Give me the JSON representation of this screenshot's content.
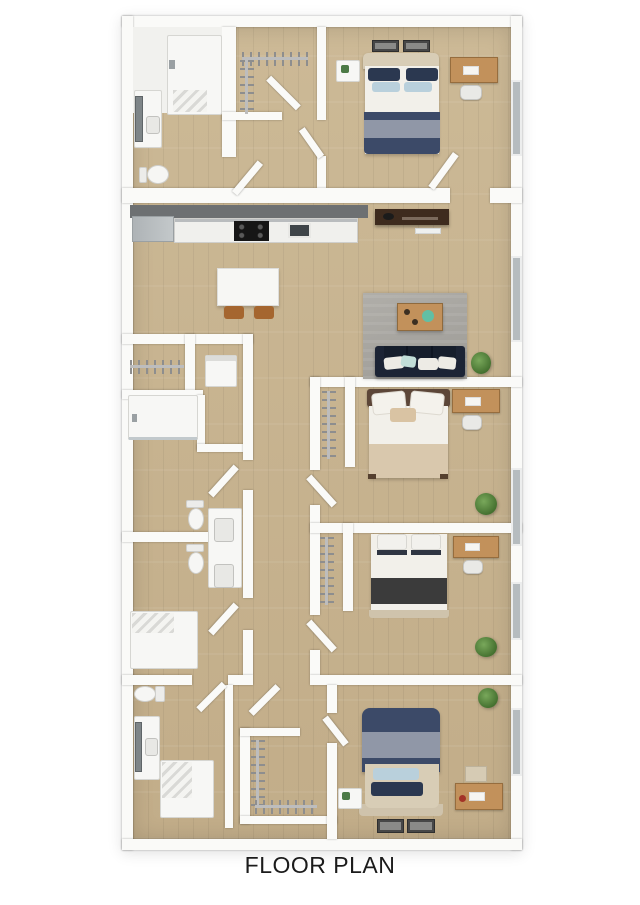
{
  "title": "FLOOR PLAN",
  "palette": {
    "bg": "#ffffff",
    "wall": "#fafaf8",
    "floor_a": "#ccb996",
    "floor_b": "#c2ad89",
    "window_gray": "#b6bcbf",
    "fixture_white": "#f7f7f5",
    "fixture_edge": "#d6d6d2",
    "rug": "#a8a6a1",
    "sofa": "#1c2435",
    "sofa_dark": "#161e2c",
    "pillow_white": "#edebe5",
    "pillow_teal": "#c2ded8",
    "bed_navy": "#3c4a68",
    "bed_navy_dark": "#2b3850",
    "bed_gray": "#9097a7",
    "bed_lightblue": "#b9d0dc",
    "sheet_white": "#f2f0ea",
    "blanket_tan": "#d9c8ad",
    "blanket_charcoal": "#3b3b3b",
    "headboard_tan": "#d8cdb6",
    "headboard_brown": "#5c4638",
    "wood_desk": "#c2915b",
    "chair_brown": "#a5662f",
    "media_brown": "#3e2b1e",
    "counter_dark": "#6d7072",
    "counter_face": "#f0f0ed",
    "appliance_black": "#161616",
    "sink_dark": "#3f4549",
    "fridge_gray": "#c3c8ca",
    "plant_a": "#79a85b",
    "plant_b": "#44702f",
    "mirror": "#7e8588",
    "frame_dark": "#474747",
    "text": "#1b1b1b"
  },
  "rooms": [
    {
      "name": "bedroom-top-right",
      "furniture": [
        "double-bed-navy-striped",
        "nightstand",
        "wall-art-two-frames",
        "wood-desk",
        "desk-chair",
        "window"
      ]
    },
    {
      "name": "ensuite-bathroom-top-left",
      "furniture": [
        "bathtub-shower",
        "vanity-sink",
        "leaning-mirror",
        "toilet"
      ]
    },
    {
      "name": "walk-in-closet-top",
      "furniture": [
        "hanging-rail-top",
        "hanging-rail-left",
        "door"
      ]
    },
    {
      "name": "kitchen",
      "furniture": [
        "refrigerator",
        "counter-run",
        "cooktop",
        "kitchen-sink",
        "dining-table",
        "dining-chair-left",
        "dining-chair-right"
      ]
    },
    {
      "name": "living-room",
      "furniture": [
        "media-console",
        "floor-vent",
        "area-rug",
        "coffee-table",
        "navy-sofa",
        "floor-plant",
        "window"
      ]
    },
    {
      "name": "bedroom-middle-right",
      "furniture": [
        "double-bed-beige",
        "closet-hanging-rail",
        "wood-desk",
        "desk-chair",
        "floor-plant",
        "window"
      ]
    },
    {
      "name": "bedroom-lower-right",
      "furniture": [
        "double-bed-charcoal",
        "closet-hanging-rail",
        "wood-desk",
        "desk-chair",
        "floor-plant",
        "window"
      ]
    },
    {
      "name": "laundry-closet",
      "furniture": [
        "hanging-rail",
        "appliance-box"
      ]
    },
    {
      "name": "hall-bathroom-upper",
      "furniture": [
        "walk-in-shower",
        "toilet",
        "vanity-sink"
      ]
    },
    {
      "name": "hall-bathroom-lower",
      "furniture": [
        "toilet",
        "double-vanity",
        "walk-in-shower"
      ]
    },
    {
      "name": "bathroom-bottom-left",
      "furniture": [
        "toilet",
        "vanity-sink",
        "leaning-mirror",
        "walk-in-shower"
      ]
    },
    {
      "name": "walk-in-closet-bottom",
      "furniture": [
        "hanging-rail-left",
        "hanging-rail-bottom",
        "door"
      ]
    },
    {
      "name": "bedroom-bottom-right",
      "furniture": [
        "double-bed-navy-striped",
        "nightstand",
        "wood-desk",
        "printer-box",
        "wall-art-two-frames",
        "floor-plant",
        "window"
      ]
    }
  ],
  "windows_on_right_wall": 5
}
